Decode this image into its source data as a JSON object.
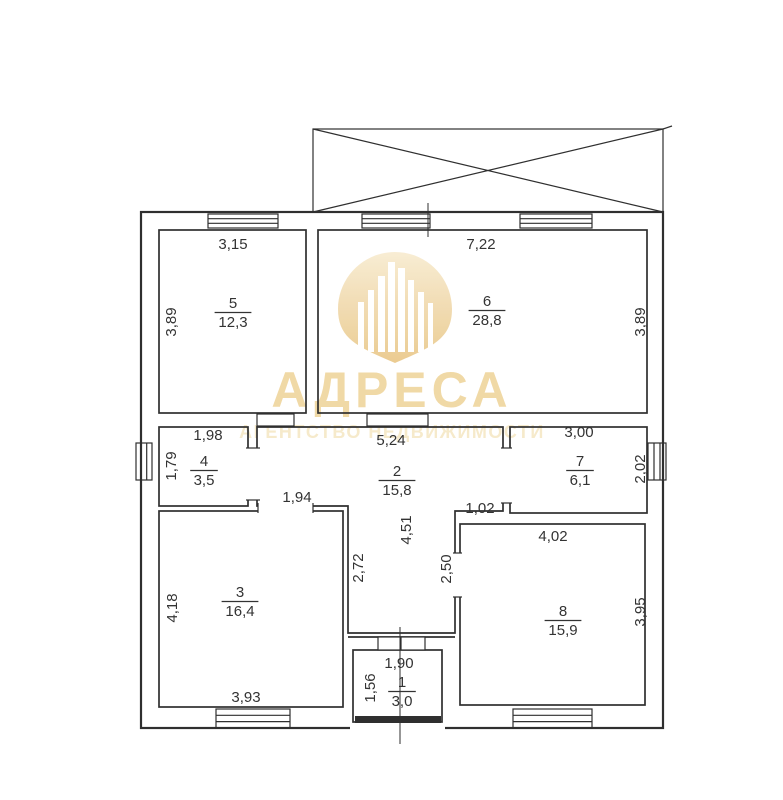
{
  "watermark": {
    "brand": "АДРЕСА",
    "tagline": "АГЕНТСТВО НЕДВИЖИМОСТИ"
  },
  "colors": {
    "wall": "#2f2f2f",
    "text": "#333333",
    "brand": "#f0d7a2",
    "tagline": "#f6e9c9",
    "pin_top": "#f8ecd2",
    "pin_bottom": "#eac98c"
  },
  "plan": {
    "units": "m",
    "rooms": [
      {
        "number": "5",
        "area": "12,3",
        "x": 233,
        "y": 308
      },
      {
        "number": "6",
        "area": "28,8",
        "x": 487,
        "y": 306
      },
      {
        "number": "4",
        "area": "3,5",
        "x": 204,
        "y": 466
      },
      {
        "number": "2",
        "area": "15,8",
        "x": 397,
        "y": 476
      },
      {
        "number": "7",
        "area": "6,1",
        "x": 580,
        "y": 466
      },
      {
        "number": "3",
        "area": "16,4",
        "x": 240,
        "y": 597
      },
      {
        "number": "8",
        "area": "15,9",
        "x": 563,
        "y": 616
      },
      {
        "number": "1",
        "area": "3,0",
        "x": 402,
        "y": 687
      }
    ],
    "dimensions": [
      {
        "text": "3,15",
        "x": 233,
        "y": 249,
        "rot": 0
      },
      {
        "text": "7,22",
        "x": 481,
        "y": 249,
        "rot": 0
      },
      {
        "text": "3,89",
        "x": 176,
        "y": 322,
        "rot": -90
      },
      {
        "text": "3,89",
        "x": 645,
        "y": 322,
        "rot": -90
      },
      {
        "text": "1,98",
        "x": 208,
        "y": 440,
        "rot": 0
      },
      {
        "text": "5,24",
        "x": 391,
        "y": 445,
        "rot": 0
      },
      {
        "text": "3,00",
        "x": 579,
        "y": 437,
        "rot": 0
      },
      {
        "text": "1,79",
        "x": 176,
        "y": 466,
        "rot": -90
      },
      {
        "text": "2,02",
        "x": 645,
        "y": 469,
        "rot": -90
      },
      {
        "text": "1,94",
        "x": 297,
        "y": 502,
        "rot": 0
      },
      {
        "text": "1,02",
        "x": 480,
        "y": 513,
        "rot": 0
      },
      {
        "text": "4,51",
        "x": 411,
        "y": 530,
        "rot": -90
      },
      {
        "text": "2,72",
        "x": 363,
        "y": 568,
        "rot": -90
      },
      {
        "text": "2,50",
        "x": 451,
        "y": 569,
        "rot": -90
      },
      {
        "text": "4,02",
        "x": 553,
        "y": 541,
        "rot": 0
      },
      {
        "text": "4,18",
        "x": 177,
        "y": 608,
        "rot": -90
      },
      {
        "text": "3,95",
        "x": 645,
        "y": 612,
        "rot": -90
      },
      {
        "text": "3,93",
        "x": 246,
        "y": 702,
        "rot": 0
      },
      {
        "text": "1,90",
        "x": 399,
        "y": 668,
        "rot": 0
      },
      {
        "text": "1,56",
        "x": 375,
        "y": 688,
        "rot": -90
      }
    ]
  }
}
